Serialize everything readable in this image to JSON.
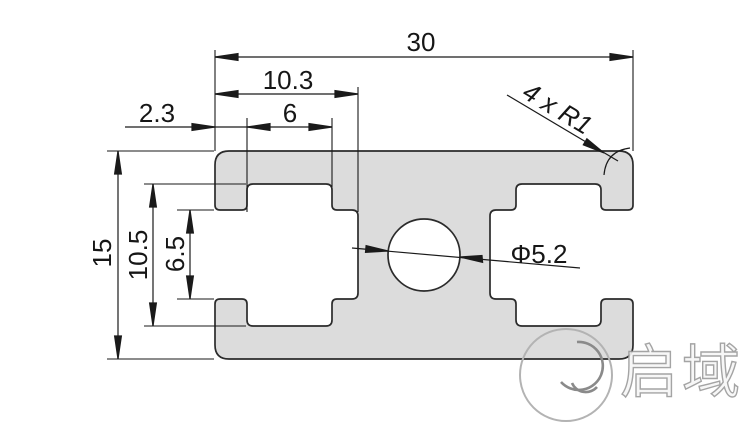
{
  "drawing": {
    "type": "aluminum-extrusion-profile-cross-section",
    "dimensions": {
      "total_width": "30",
      "slot_depth": "10.3",
      "slot_inner_width": "6",
      "lip_thickness": "2.3",
      "total_height": "15",
      "slot_cavity_height": "10.5",
      "slot_opening_height": "6.5",
      "center_hole_diameter": "Φ5.2",
      "corner_radius_note": "4 x R1"
    },
    "watermark": {
      "logo_text": "启域"
    },
    "colors": {
      "profile_fill": "#dcdcdc",
      "outline": "#2b2b2b",
      "dimension_line": "#1a1a1a",
      "dimension_text": "#161616",
      "watermark": "#9b9b9b"
    }
  }
}
